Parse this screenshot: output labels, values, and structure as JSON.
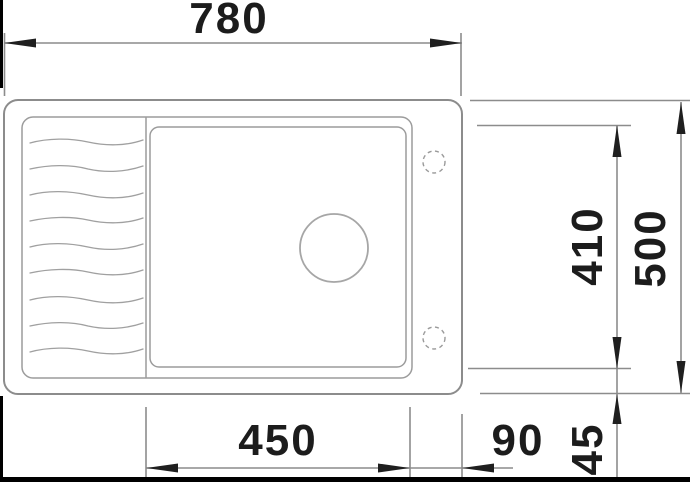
{
  "drawing": {
    "kind": "technical-drawing-top-view",
    "subject": "kitchen sink with drainboard, main bowl, drain hole and two optional tap holes",
    "units": "mm",
    "dimensions": {
      "overall_width": {
        "value": "780",
        "orientation": "horizontal",
        "position": "top"
      },
      "overall_depth": {
        "value": "500",
        "orientation": "vertical",
        "position": "right-outer"
      },
      "bowl_depth": {
        "value": "410",
        "orientation": "vertical",
        "position": "right-inner"
      },
      "bowl_length": {
        "value": "450",
        "orientation": "horizontal",
        "position": "bottom"
      },
      "right_offset": {
        "value": "90",
        "orientation": "horizontal",
        "position": "bottom-right"
      },
      "front_offset": {
        "value": "45",
        "orientation": "vertical",
        "position": "bottom-right"
      }
    },
    "features": [
      "drainboard-ripple-lines",
      "bowl-inner-outline",
      "drain-hole-circle",
      "tap-hole-dashed-circle-top",
      "tap-hole-dashed-circle-bottom"
    ],
    "colors": {
      "outline_line": "#8c8c8c",
      "inner_line": "#9c9c9c",
      "ripple_line": "#a0a0a0",
      "dimension_line": "#8c8c8c",
      "arrow_and_text": "#1c1c1c",
      "frame_border": "#000000",
      "background": "#ffffff"
    }
  }
}
